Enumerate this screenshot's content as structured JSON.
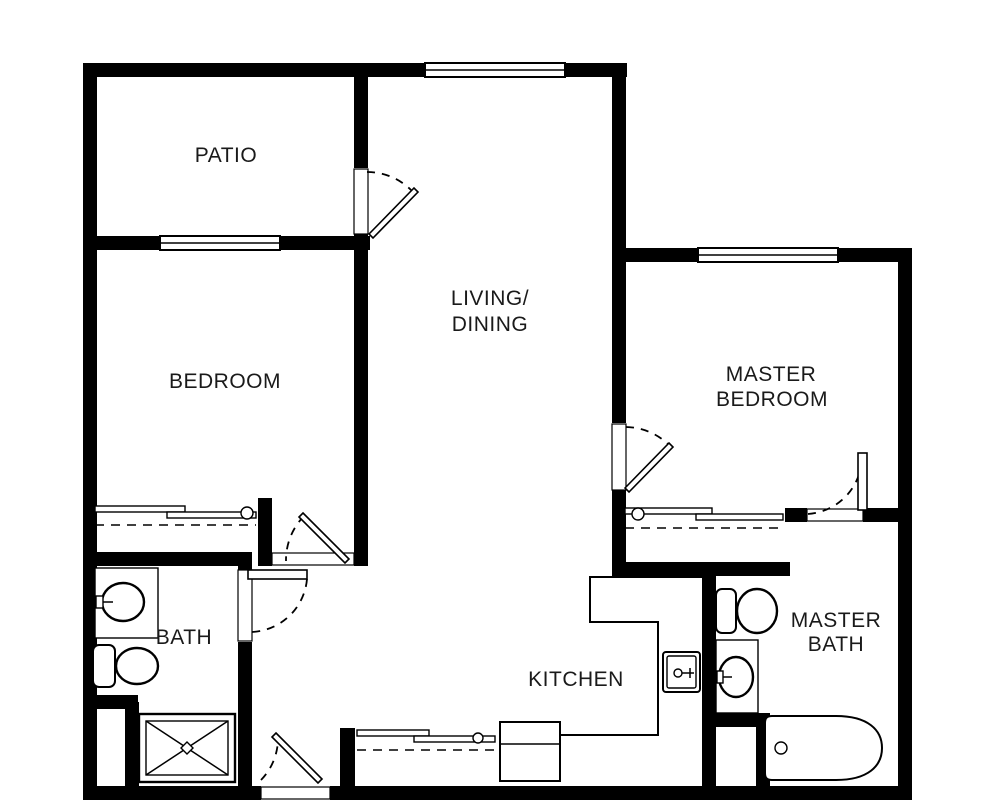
{
  "title": "Floor plan",
  "colors": {
    "wall": "#000000",
    "background": "#ffffff",
    "text": "#1a1a1a"
  },
  "labels": {
    "patio": "PATIO",
    "bedroom": "BEDROOM",
    "living_line1": "LIVING/",
    "living_line2": "DINING",
    "master_bedroom_line1": "MASTER",
    "master_bedroom_line2": "BEDROOM",
    "bath": "BATH",
    "kitchen": "KITCHEN",
    "master_bath_line1": "MASTER",
    "master_bath_line2": "BATH"
  },
  "fixture_icons": [
    "toilet-icon",
    "sink-icon",
    "shower-icon",
    "bathtub-icon",
    "kitchen-sink-icon",
    "range-icon",
    "closet-bypass-doors-icon",
    "door-swing-icon",
    "window-icon"
  ]
}
